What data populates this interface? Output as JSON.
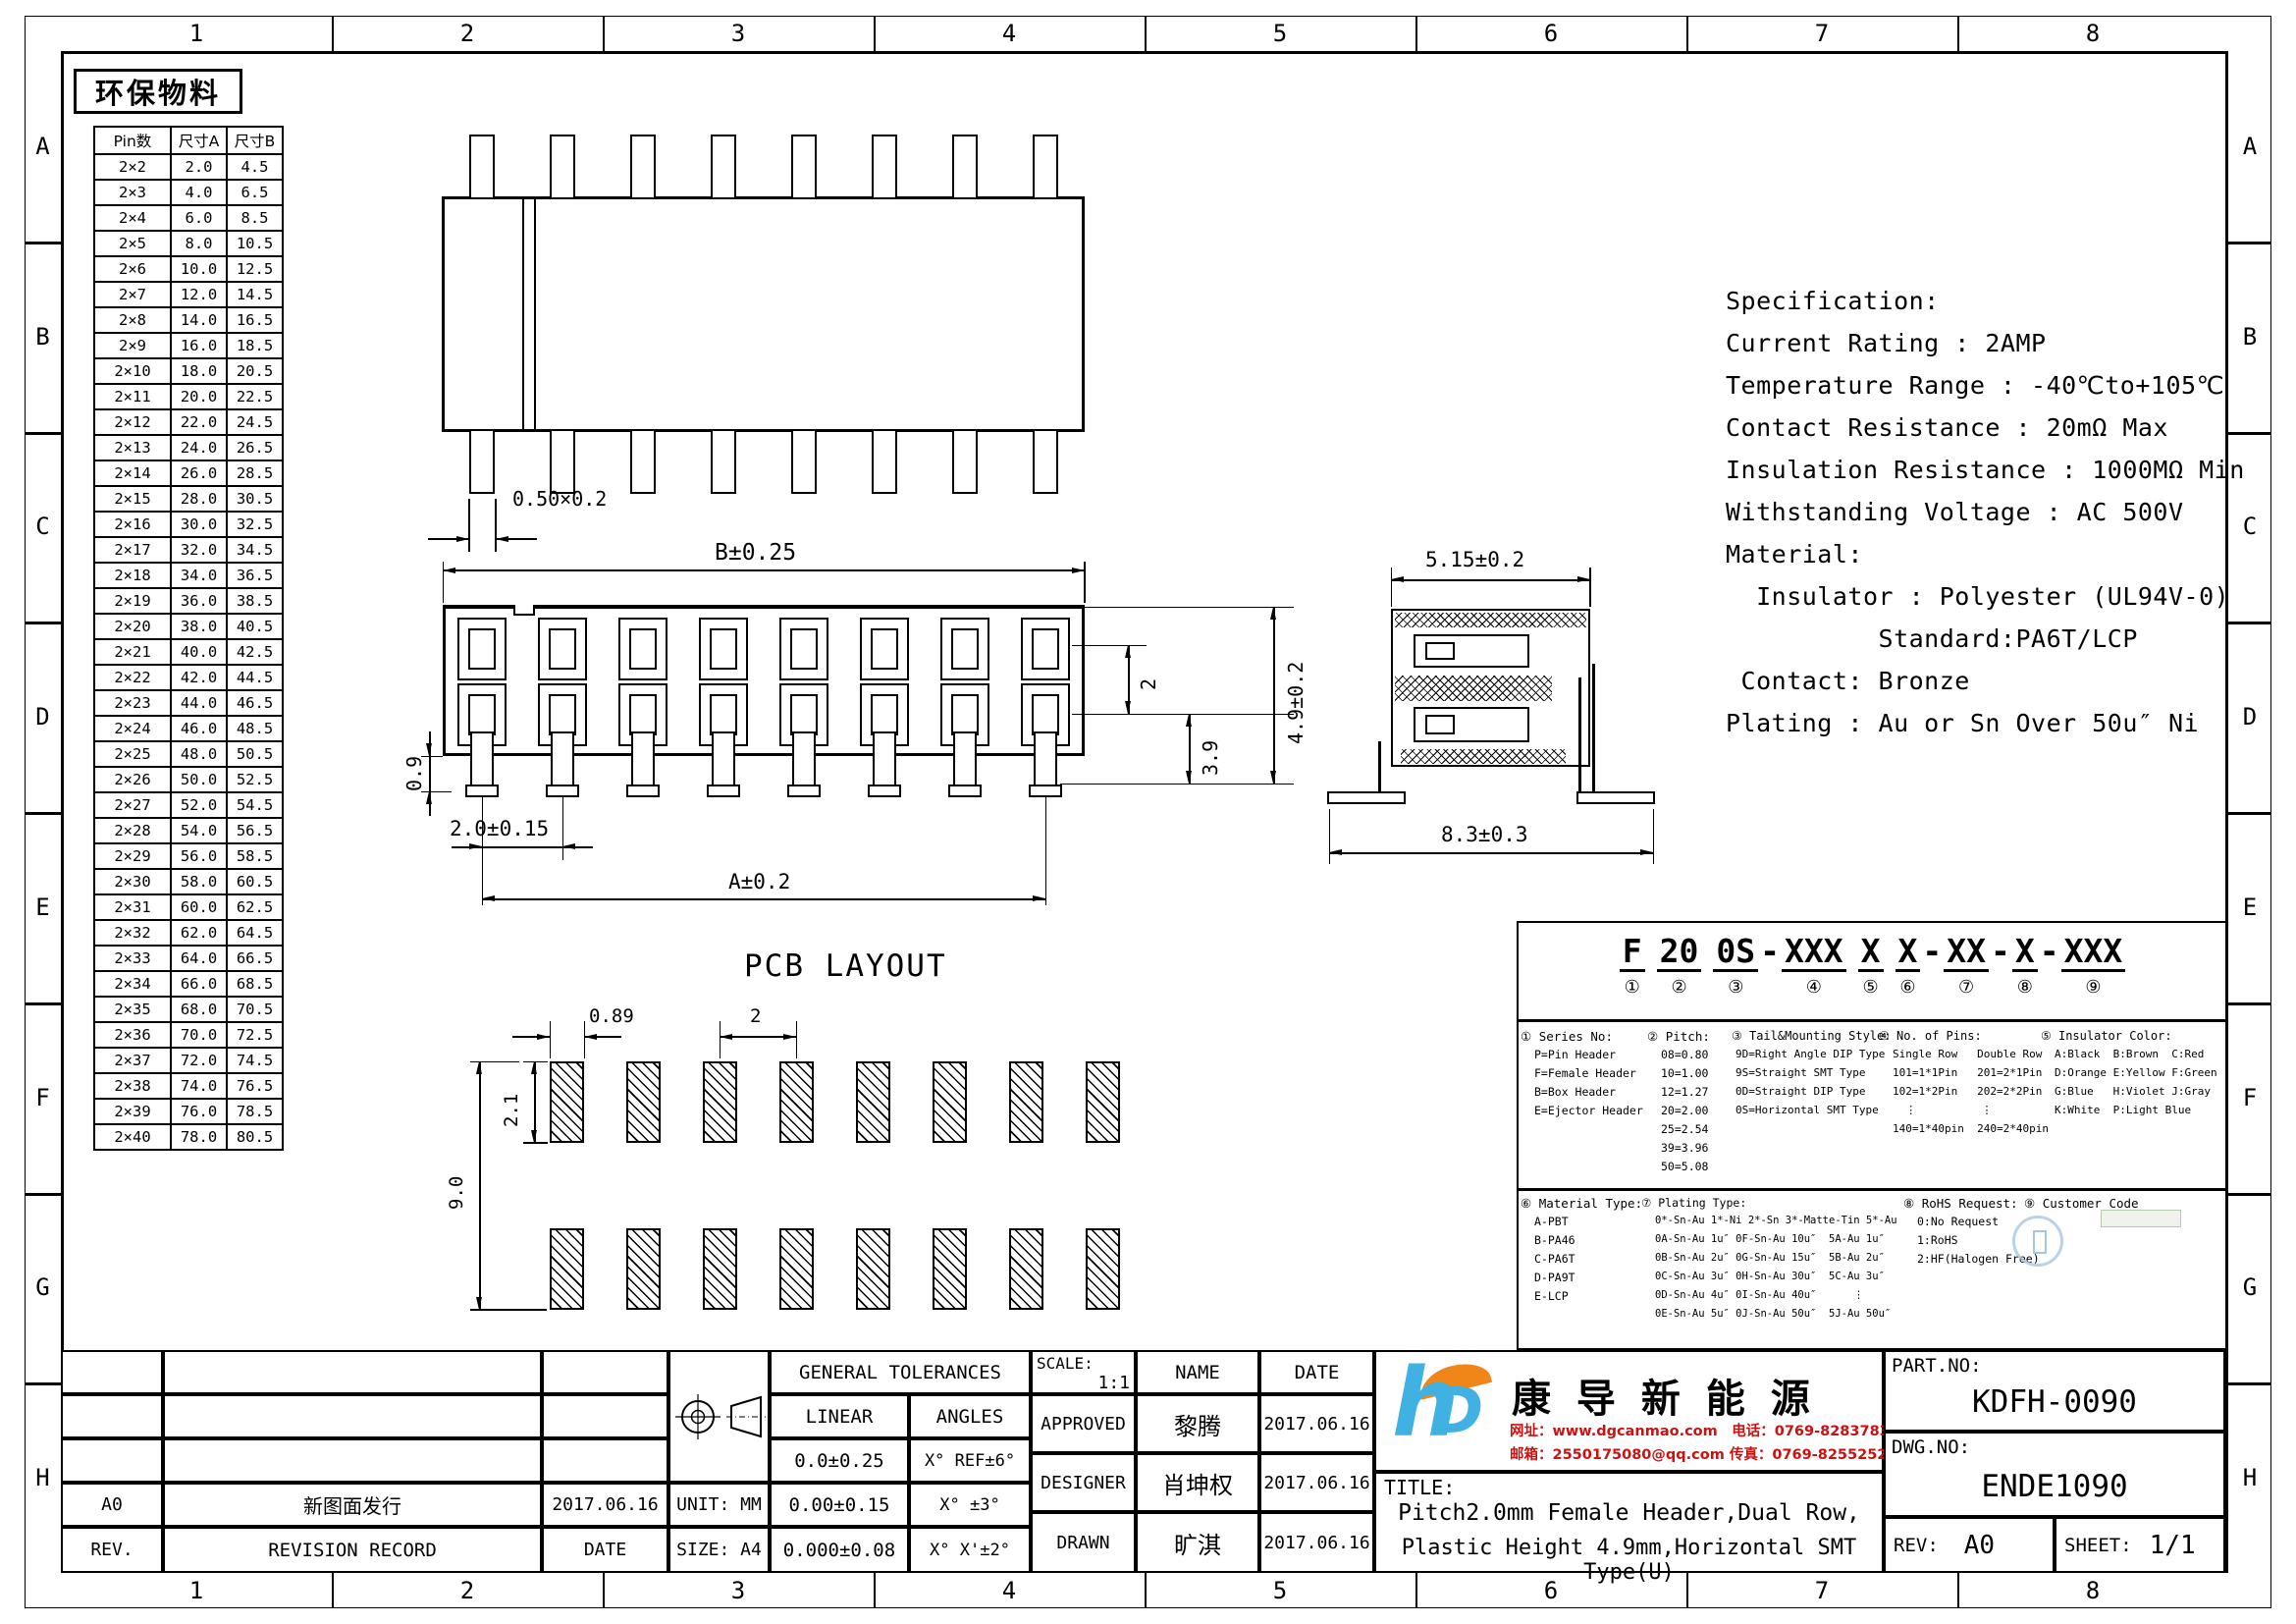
{
  "frame": {
    "cols": [
      "1",
      "2",
      "3",
      "4",
      "5",
      "6",
      "7",
      "8"
    ],
    "rows": [
      "A",
      "B",
      "C",
      "D",
      "E",
      "F",
      "G",
      "H"
    ]
  },
  "eco_label": "环保物料",
  "pin_table": {
    "headers": [
      "Pin数",
      "尺寸A",
      "尺寸B"
    ],
    "rows": [
      [
        "2×2",
        "2.0",
        "4.5"
      ],
      [
        "2×3",
        "4.0",
        "6.5"
      ],
      [
        "2×4",
        "6.0",
        "8.5"
      ],
      [
        "2×5",
        "8.0",
        "10.5"
      ],
      [
        "2×6",
        "10.0",
        "12.5"
      ],
      [
        "2×7",
        "12.0",
        "14.5"
      ],
      [
        "2×8",
        "14.0",
        "16.5"
      ],
      [
        "2×9",
        "16.0",
        "18.5"
      ],
      [
        "2×10",
        "18.0",
        "20.5"
      ],
      [
        "2×11",
        "20.0",
        "22.5"
      ],
      [
        "2×12",
        "22.0",
        "24.5"
      ],
      [
        "2×13",
        "24.0",
        "26.5"
      ],
      [
        "2×14",
        "26.0",
        "28.5"
      ],
      [
        "2×15",
        "28.0",
        "30.5"
      ],
      [
        "2×16",
        "30.0",
        "32.5"
      ],
      [
        "2×17",
        "32.0",
        "34.5"
      ],
      [
        "2×18",
        "34.0",
        "36.5"
      ],
      [
        "2×19",
        "36.0",
        "38.5"
      ],
      [
        "2×20",
        "38.0",
        "40.5"
      ],
      [
        "2×21",
        "40.0",
        "42.5"
      ],
      [
        "2×22",
        "42.0",
        "44.5"
      ],
      [
        "2×23",
        "44.0",
        "46.5"
      ],
      [
        "2×24",
        "46.0",
        "48.5"
      ],
      [
        "2×25",
        "48.0",
        "50.5"
      ],
      [
        "2×26",
        "50.0",
        "52.5"
      ],
      [
        "2×27",
        "52.0",
        "54.5"
      ],
      [
        "2×28",
        "54.0",
        "56.5"
      ],
      [
        "2×29",
        "56.0",
        "58.5"
      ],
      [
        "2×30",
        "58.0",
        "60.5"
      ],
      [
        "2×31",
        "60.0",
        "62.5"
      ],
      [
        "2×32",
        "62.0",
        "64.5"
      ],
      [
        "2×33",
        "64.0",
        "66.5"
      ],
      [
        "2×34",
        "66.0",
        "68.5"
      ],
      [
        "2×35",
        "68.0",
        "70.5"
      ],
      [
        "2×36",
        "70.0",
        "72.5"
      ],
      [
        "2×37",
        "72.0",
        "74.5"
      ],
      [
        "2×38",
        "74.0",
        "76.5"
      ],
      [
        "2×39",
        "76.0",
        "78.5"
      ],
      [
        "2×40",
        "78.0",
        "80.5"
      ]
    ]
  },
  "views": {
    "top": {
      "slot_dim": "0.50×0.2"
    },
    "front": {
      "dim_b": "B±0.25",
      "dim_pitch": "2.0±0.15",
      "dim_a": "A±0.2",
      "dim_row": "2",
      "dim_39": "3.9",
      "dim_49": "4.9±0.2",
      "dim_09": "0.9"
    },
    "side": {
      "dim_w": "5.15±0.2",
      "dim_span": "8.3±0.3"
    },
    "pcb": {
      "title": "PCB LAYOUT",
      "dim_w": "0.89",
      "dim_pitch": "2",
      "dim_h": "2.1",
      "dim_span": "9.0"
    }
  },
  "spec": {
    "lines": [
      "Specification:",
      "Current Rating : 2AMP",
      "Temperature Range : -40℃to+105℃",
      "Contact Resistance : 20mΩ Max",
      "Insulation Resistance : 1000MΩ Min",
      "Withstanding Voltage : AC 500V",
      "Material:",
      "  Insulator : Polyester (UL94V-0)",
      "          Standard:PA6T/LCP",
      " Contact: Bronze",
      "Plating : Au or Sn Over 50u″ Ni"
    ]
  },
  "part_code": {
    "segments": [
      {
        "text": "F",
        "num": "①",
        "pre": ""
      },
      {
        "text": "20",
        "num": "②",
        "pre": ""
      },
      {
        "text": "0S",
        "num": "③",
        "pre": ""
      },
      {
        "text": "XXX",
        "num": "④",
        "pre": "-"
      },
      {
        "text": "X",
        "num": "⑤",
        "pre": ""
      },
      {
        "text": "X",
        "num": "⑥",
        "pre": ""
      },
      {
        "text": "XX",
        "num": "⑦",
        "pre": "-"
      },
      {
        "text": "X",
        "num": "⑧",
        "pre": "-"
      },
      {
        "text": "XXX",
        "num": "⑨",
        "pre": "-"
      }
    ]
  },
  "legend": {
    "series": {
      "header": "① Series No:",
      "lines": [
        "P=Pin Header",
        "F=Female Header",
        "B=Box Header",
        "E=Ejector Header"
      ]
    },
    "pitch": {
      "header": "② Pitch:",
      "lines": [
        "08=0.80",
        "10=1.00",
        "12=1.27",
        "20=2.00",
        "25=2.54",
        "39=3.96",
        "50=5.08"
      ]
    },
    "tail": {
      "header": "③ Tail&Mounting Style:",
      "lines": [
        "9D=Right Angle DIP Type",
        "9S=Straight SMT Type",
        "0D=Straight DIP Type",
        "0S=Horizontal SMT Type"
      ]
    },
    "pins": {
      "header": "④ No. of Pins:",
      "lines": [
        "Single Row   Double Row",
        "101=1*1Pin   201=2*1Pin",
        "102=1*2Pin   202=2*2Pin",
        "  ⋮          ⋮",
        "140=1*40pin  240=2*40pin"
      ]
    },
    "color": {
      "header": "⑤ Insulator Color:",
      "lines": [
        "A:Black  B:Brown  C:Red",
        "D:Orange E:Yellow F:Green",
        "G:Blue   H:Violet J:Gray",
        "K:White  P:Light Blue"
      ]
    },
    "material": {
      "header": "⑥ Material Type:",
      "lines": [
        "A-PBT",
        "B-PA46",
        "C-PA6T",
        "D-PA9T",
        "E-LCP"
      ]
    },
    "plating": {
      "header": "⑦ Plating Type:",
      "lines": [
        "0*-Sn-Au 1*-Ni 2*-Sn 3*-Matte-Tin 5*-Au",
        "0A-Sn-Au 1u″ 0F-Sn-Au 10u″  5A-Au 1u″",
        "0B-Sn-Au 2u″ 0G-Sn-Au 15u″  5B-Au 2u″",
        "0C-Sn-Au 3u″ 0H-Sn-Au 30u″  5C-Au 3u″",
        "0D-Sn-Au 4u″ 0I-Sn-Au 40u″      ⋮",
        "0E-Sn-Au 5u″ 0J-Sn-Au 50u″  5J-Au 50u″"
      ]
    },
    "rohs": {
      "header": "⑧ RoHS Request:",
      "lines": [
        "0:No Request",
        "1:RoHS",
        "2:HF(Halogen Free)"
      ]
    },
    "customer": {
      "header": "⑨ Customer Code",
      "lines": []
    }
  },
  "tolerances": {
    "title": "GENERAL TOLERANCES",
    "linear_h": "LINEAR",
    "angles_h": "ANGLES",
    "linear": [
      "0.0±0.25",
      "0.00±0.15",
      "0.000±0.08"
    ],
    "angles": [
      "X° REF±6°",
      "X° ±3°",
      "X° X'±2°"
    ],
    "unit": "UNIT: MM",
    "size": "SIZE: A4"
  },
  "approval": {
    "scale_label": "SCALE:",
    "scale": "1:1",
    "name_h": "NAME",
    "date_h": "DATE",
    "rows": [
      {
        "role": "APPROVED",
        "name": "黎腾",
        "date": "2017.06.16"
      },
      {
        "role": "DESIGNER",
        "name": "肖坤权",
        "date": "2017.06.16"
      },
      {
        "role": "DRAWN",
        "name": "旷淇",
        "date": "2017.06.16"
      }
    ]
  },
  "revision": {
    "entry": {
      "rev": "A0",
      "record": "新图面发行",
      "date": "2017.06.16"
    },
    "footer": {
      "rev": "REV.",
      "record": "REVISION RECORD",
      "date": "DATE"
    }
  },
  "title_block": {
    "company": "康 导 新 能 源",
    "contact_line1": "网址：www.dgcanmao.com　电话：0769-82837833",
    "contact_line2": "邮箱：2550175080@qq.com 传真：0769-82552527",
    "title_label": "TITLE:",
    "title_line1": "Pitch2.0mm Female Header,Dual Row,",
    "title_line2": "Plastic Height 4.9mm,Horizontal SMT Type(U)",
    "part_label": "PART.NO:",
    "part_no": "KDFH-0090",
    "dwg_label": "DWG.NO:",
    "dwg_no": "ENDE1090",
    "rev_label": "REV:",
    "rev": "A0",
    "sheet_label": "SHEET:",
    "sheet": "1/1"
  },
  "colors": {
    "logo_blue": "#3fb1e3",
    "logo_orange": "#f08519",
    "contact_red": "#cc1111",
    "stamp_blue": "#a8c8e6"
  }
}
